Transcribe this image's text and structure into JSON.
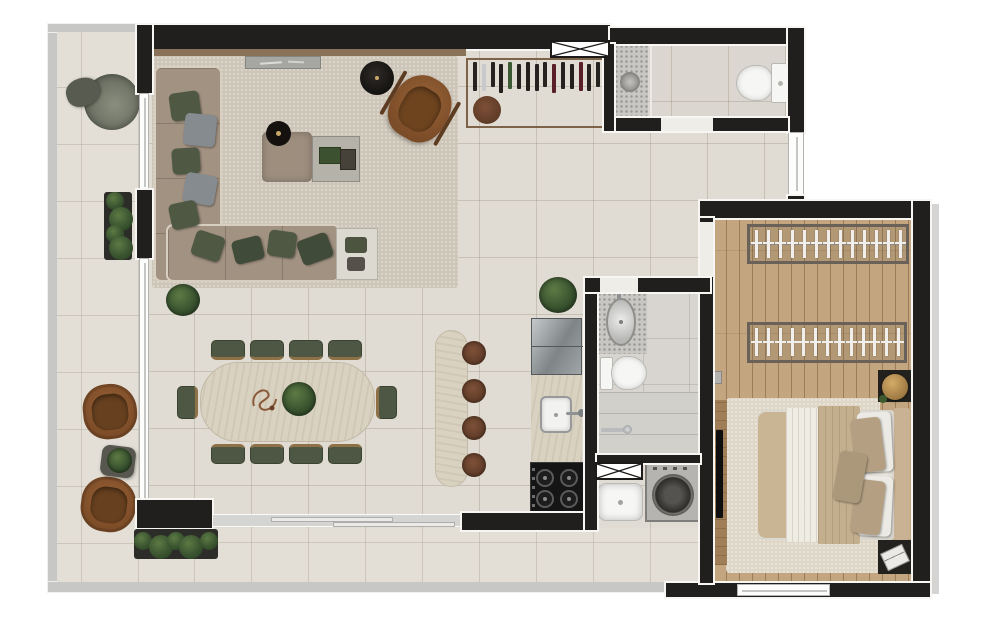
{
  "scene": {
    "type": "apartment-floor-plan-render",
    "view": "top-down",
    "background": "#ffffff",
    "has_text": false
  },
  "rooms": [
    {
      "id": "terrace",
      "position": "L-shape left and bottom",
      "floor": "beige tile"
    },
    {
      "id": "living-room",
      "position": "top-left",
      "floor": "beige tile"
    },
    {
      "id": "dining-area",
      "position": "center-left",
      "floor": "beige tile"
    },
    {
      "id": "kitchen",
      "position": "center",
      "floor": "beige tile"
    },
    {
      "id": "bathroom-1",
      "position": "top-right",
      "floor": "gray tile"
    },
    {
      "id": "hall",
      "position": "right of living",
      "floor": "beige tile"
    },
    {
      "id": "bathroom-2",
      "position": "center-right",
      "floor": "gray tile"
    },
    {
      "id": "laundry",
      "position": "below bathroom-2",
      "floor": "beige tile"
    },
    {
      "id": "bedroom",
      "position": "right",
      "floor": "light wood"
    }
  ],
  "colors": {
    "wall": "#211f1d",
    "terrace_tile": "#e3dfd6",
    "interior_tile": "#e0dcd3",
    "wood_floor": "#c3a67f",
    "living_rug": "#cdc5b7",
    "bedroom_rug": "#ded7c7",
    "sofa": "#a29282",
    "pillow_olive": "#4e5843",
    "pillow_gray": "#868b8f",
    "dining_chair_green": "#4d5744",
    "travertine": "#d9d2c1",
    "leather_brown": "#8a5731",
    "plant_green": "#3a5430",
    "stool_brown": "#6f4527",
    "appliance_black": "#141414",
    "fixture_white": "#f6f6f4",
    "gold_lamp": "#b08d4f"
  },
  "generated": {
    "wine_rack": {
      "x": 473,
      "y": 62,
      "bottle_w": 4,
      "bottle_h": 29,
      "gap": 8.8,
      "colors": [
        "#26221f",
        "#c7c9cb",
        "#26221f",
        "#221f1c",
        "#3c5a33",
        "#26221f",
        "#221f1c",
        "#26221f",
        "#26221f",
        "#5a1f26",
        "#26221f",
        "#221f1c",
        "#5a1f26",
        "#26221f",
        "#26221f"
      ]
    },
    "closet_rails": [
      {
        "x": 747,
        "y": 224,
        "w": 162,
        "h": 40,
        "hangers": 13
      },
      {
        "x": 747,
        "y": 322,
        "w": 160,
        "h": 41,
        "hangers": 13
      }
    ],
    "dining_chairs": {
      "w": 34,
      "h": 20,
      "top": {
        "y": 340,
        "xs": [
          211,
          250,
          289,
          328
        ]
      },
      "bottom": {
        "y": 444,
        "xs": [
          211,
          250,
          289,
          328
        ]
      },
      "left": {
        "x": 177,
        "y": 386,
        "w": 21,
        "h": 33
      },
      "right": {
        "x": 376,
        "y": 386,
        "w": 21,
        "h": 33
      }
    },
    "island_stools": {
      "cx": 474,
      "r": 12,
      "cys": [
        353,
        391,
        428,
        465
      ]
    },
    "cooktop_burners": {
      "r": 9,
      "centers": [
        [
          545,
          478
        ],
        [
          569,
          478
        ],
        [
          545,
          499
        ],
        [
          569,
          499
        ]
      ]
    },
    "hedges": [
      {
        "x": 104,
        "y": 192,
        "w": 28,
        "h": 68,
        "blobs": 4,
        "dir": "v"
      },
      {
        "x": 134,
        "y": 529,
        "w": 84,
        "h": 30,
        "blobs": 5,
        "dir": "h"
      }
    ],
    "sofa_pillows": [
      {
        "x": 170,
        "y": 92,
        "w": 30,
        "h": 28,
        "rot": -8,
        "c": "#4e5843"
      },
      {
        "x": 184,
        "y": 114,
        "w": 32,
        "h": 32,
        "rot": 6,
        "c": "#868b8f"
      },
      {
        "x": 172,
        "y": 148,
        "w": 28,
        "h": 26,
        "rot": -4,
        "c": "#4e5843"
      },
      {
        "x": 184,
        "y": 174,
        "w": 32,
        "h": 30,
        "rot": 10,
        "c": "#868b8f"
      },
      {
        "x": 170,
        "y": 202,
        "w": 28,
        "h": 26,
        "rot": -12,
        "c": "#4e5843"
      },
      {
        "x": 193,
        "y": 233,
        "w": 30,
        "h": 26,
        "rot": 18,
        "c": "#4e5843"
      },
      {
        "x": 233,
        "y": 238,
        "w": 30,
        "h": 24,
        "rot": -14,
        "c": "#414b39"
      },
      {
        "x": 268,
        "y": 231,
        "w": 28,
        "h": 26,
        "rot": 8,
        "c": "#4e5843"
      },
      {
        "x": 299,
        "y": 236,
        "w": 32,
        "h": 26,
        "rot": -20,
        "c": "#414b39"
      }
    ]
  }
}
